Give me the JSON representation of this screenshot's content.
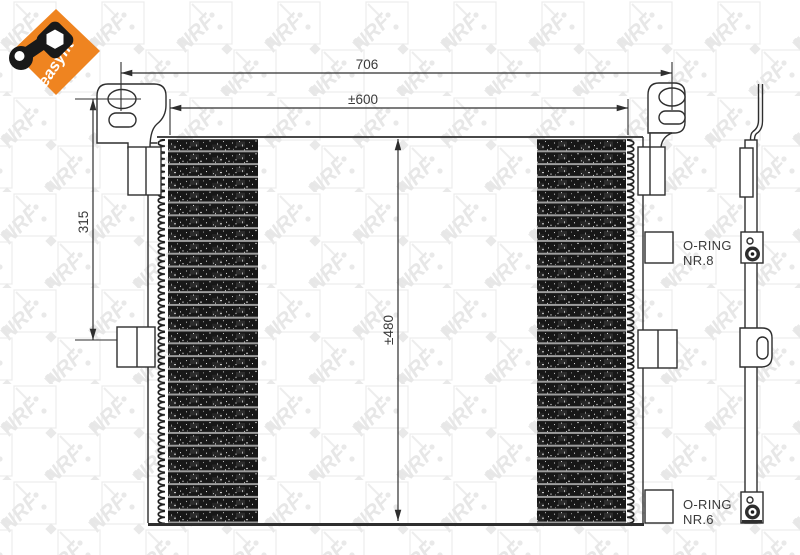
{
  "branding": {
    "easyfit_label": "easyfit",
    "watermark_text": "NRF"
  },
  "icons": {
    "easyfit_badge": "wrench-and-nut-icon"
  },
  "dimensions": {
    "overall_width": "706",
    "core_width": "±600",
    "bracket_height": "315",
    "core_height": "±480"
  },
  "annotations": {
    "oring_8_line1": "O-RING",
    "oring_8_line2": "NR.8",
    "oring_6_line1": "O-RING",
    "oring_6_line2": "NR.6"
  },
  "colors": {
    "accent_orange": "#EF8420",
    "line_color": "#2e2e2e",
    "fin_color": "#171717",
    "tube_color": "#9d9d9d",
    "watermark_gray": "#e7e7e7"
  }
}
